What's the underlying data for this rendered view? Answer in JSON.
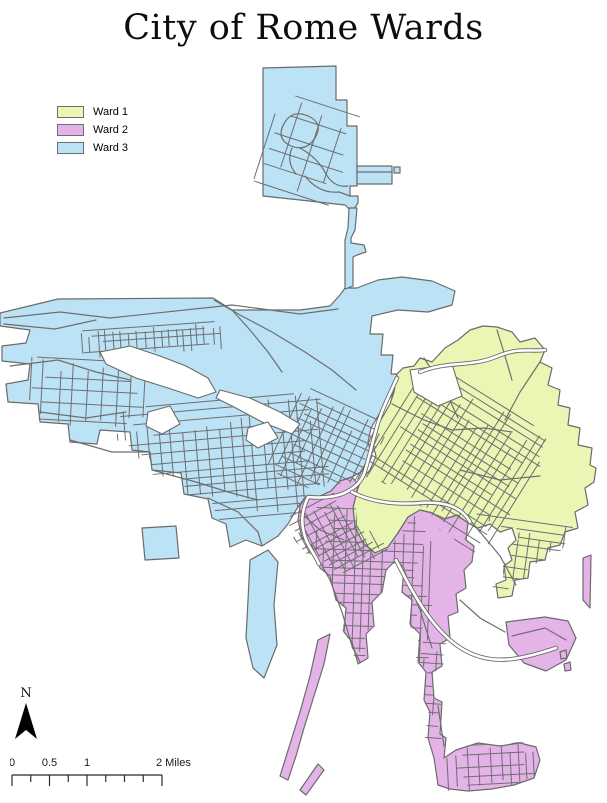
{
  "title": "City of Rome Wards",
  "legend": {
    "items": [
      {
        "label": "Ward 1",
        "color": "#e9f6b4"
      },
      {
        "label": "Ward 2",
        "color": "#e4b4e9"
      },
      {
        "label": "Ward 3",
        "color": "#bce2f5"
      }
    ]
  },
  "north_arrow": {
    "label": "N"
  },
  "scale_bar": {
    "tick_labels": [
      "0",
      "0.5",
      "1"
    ],
    "end_label": "2 Miles"
  },
  "map": {
    "outline_color": "#6b6b6b",
    "road_color": "#6e6e6e",
    "major_road_fill": "#ffffff",
    "background": "#ffffff"
  }
}
